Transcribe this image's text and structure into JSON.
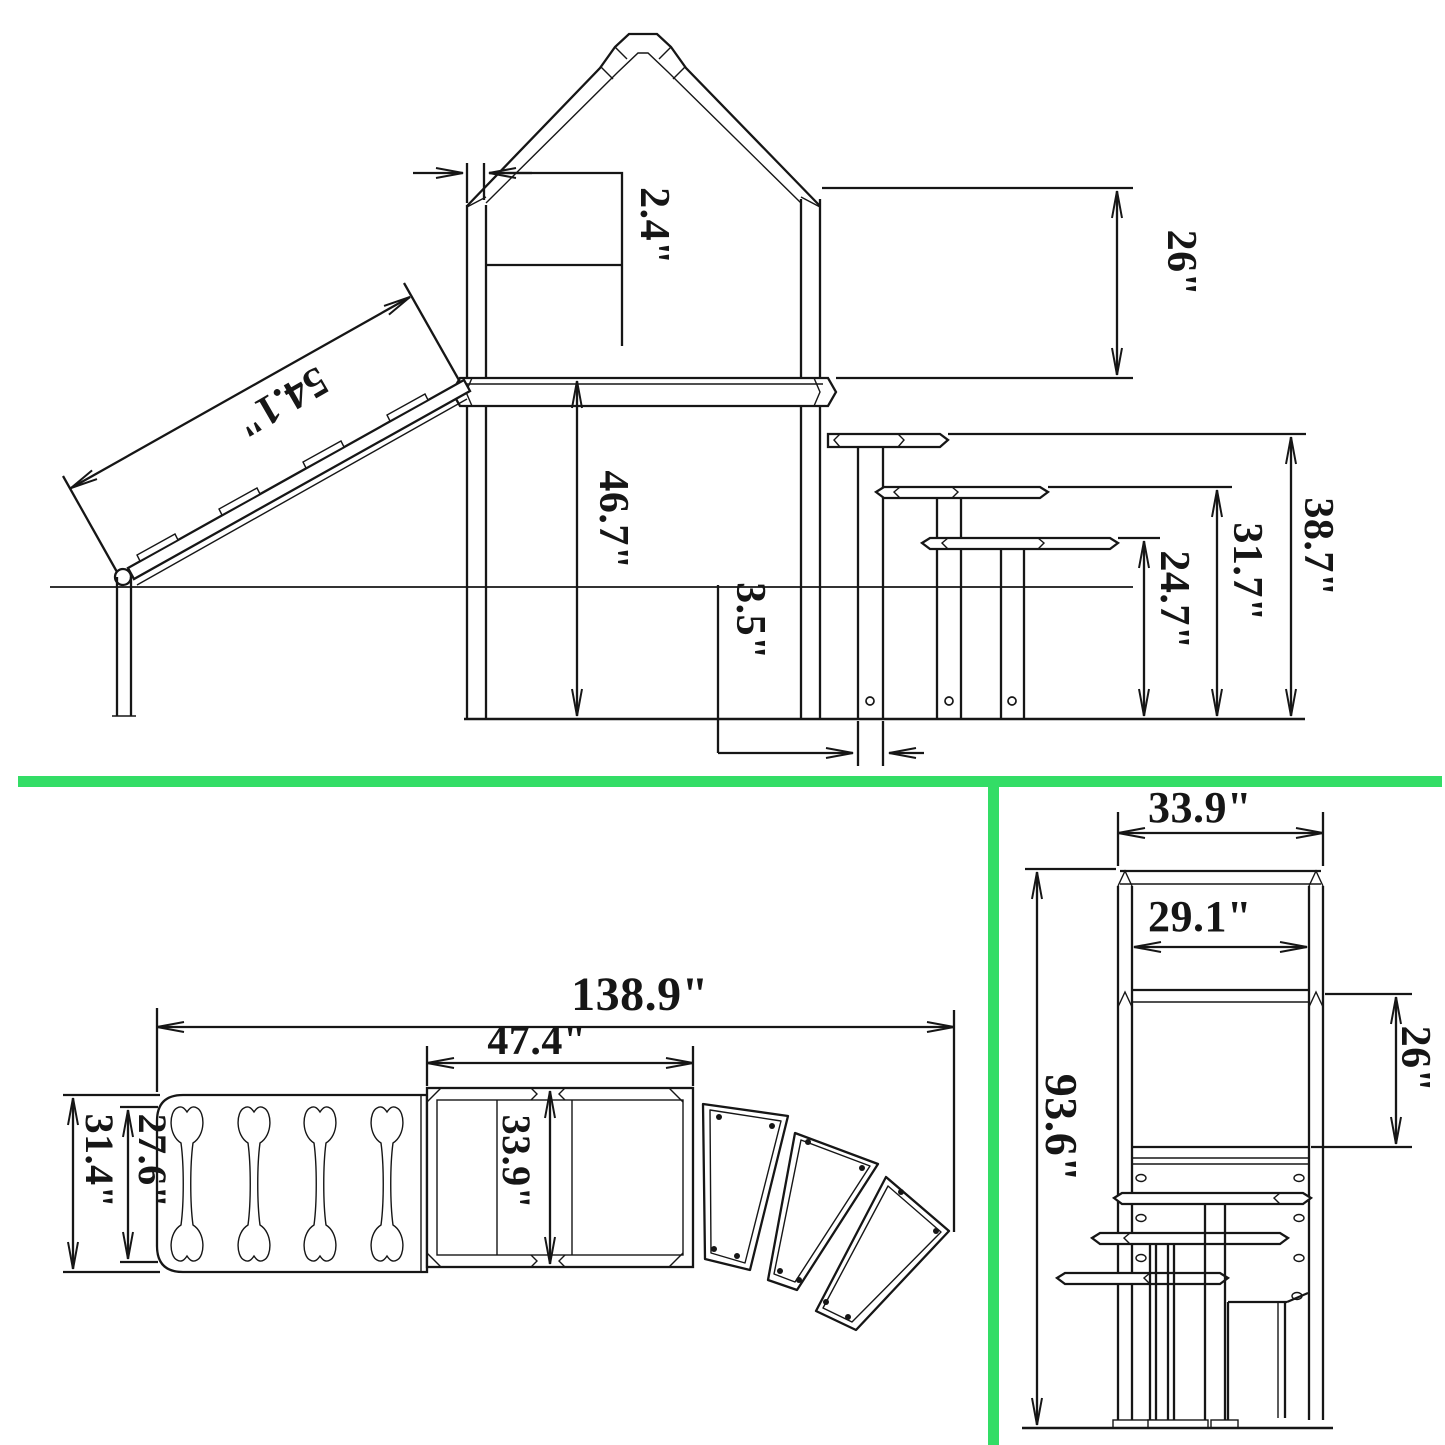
{
  "colors": {
    "line": "#161616",
    "divider": "#33dd66",
    "background": "#ffffff"
  },
  "dims": {
    "side": {
      "post_width": "2.4\"",
      "wall_height": "26\"",
      "ramp_length": "54.1\"",
      "deck_height": "46.7\"",
      "post_thickness": "3.5\"",
      "step1_height": "24.7\"",
      "step2_height": "31.7\"",
      "step3_height": "38.7\""
    },
    "plan": {
      "total_length": "138.9\"",
      "deck_length": "47.4\"",
      "ramp_width": "31.4\"",
      "ramp_inner_width": "27.6\"",
      "deck_width": "33.9\""
    },
    "front": {
      "frame_width": "33.9\"",
      "inner_width": "29.1\"",
      "total_height": "93.6\"",
      "window_height": "26\""
    }
  }
}
